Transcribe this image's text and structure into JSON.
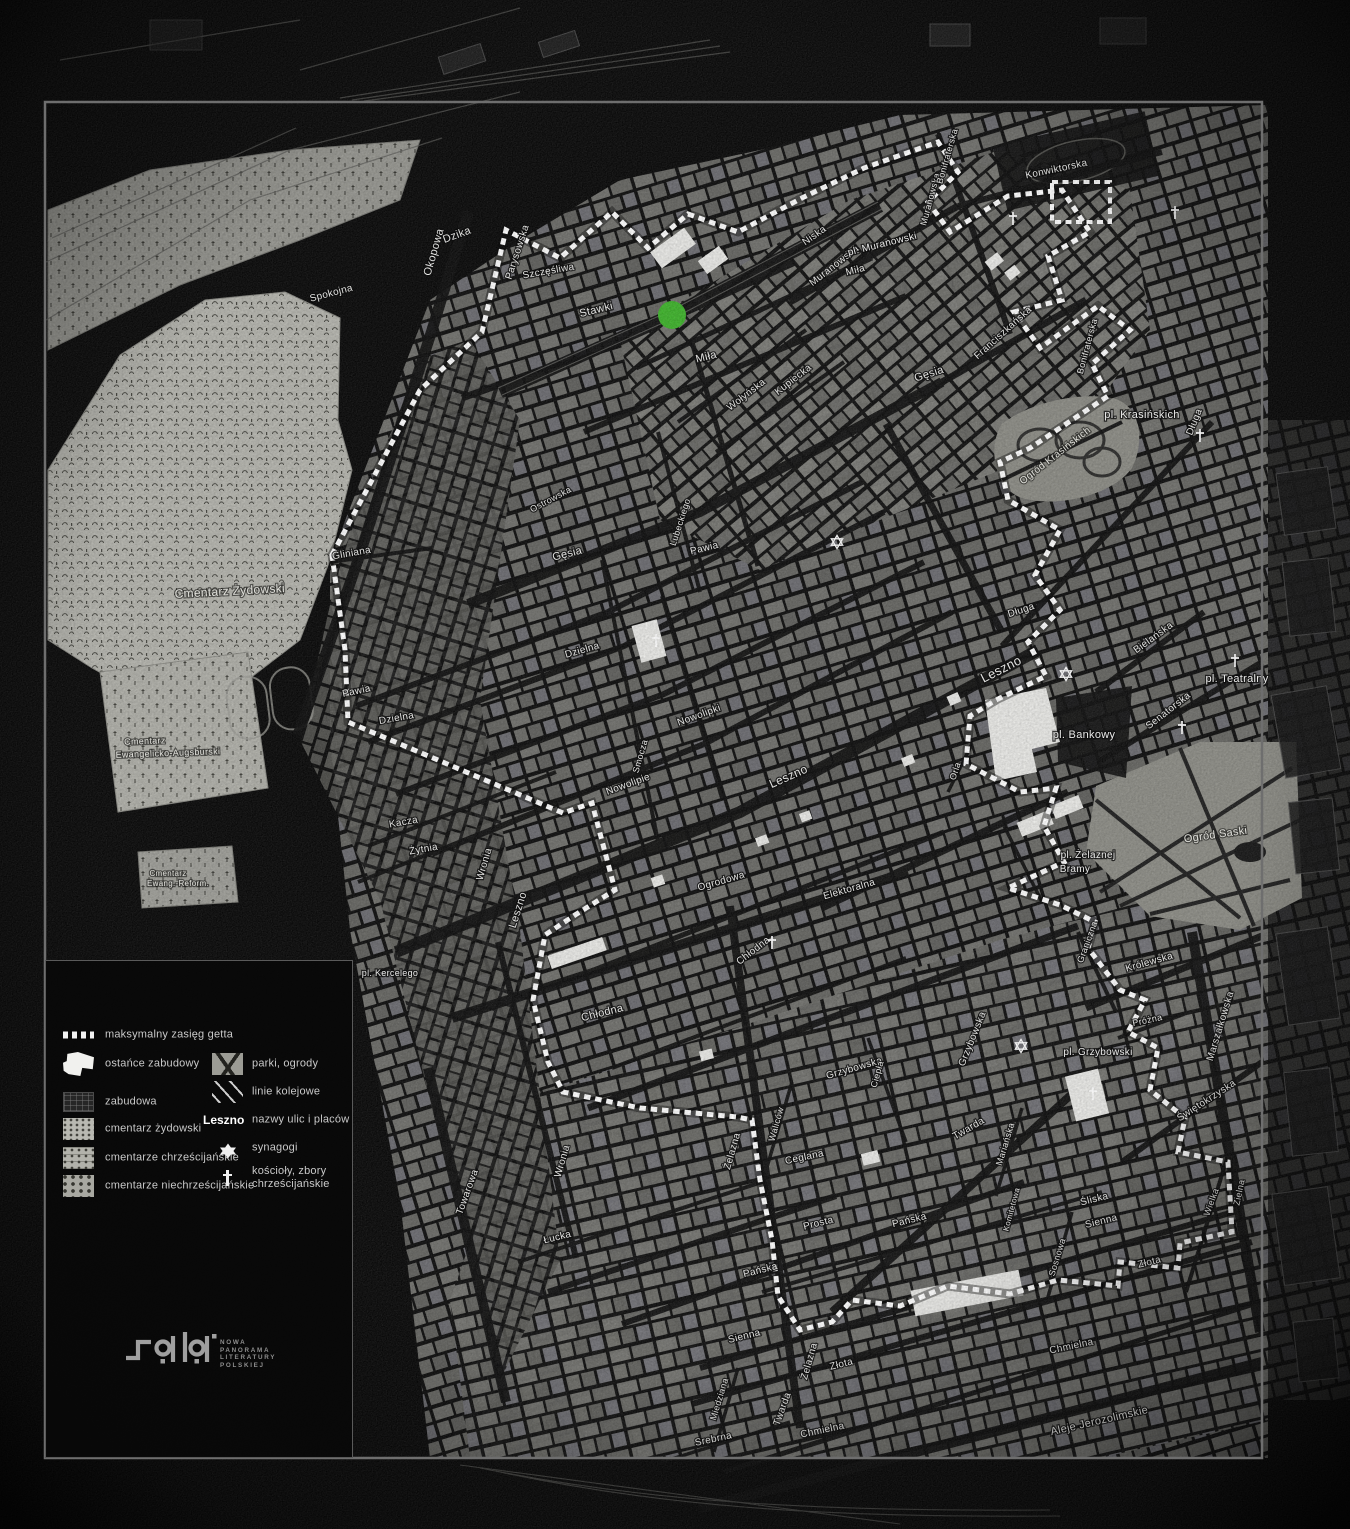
{
  "map": {
    "marker": {
      "name": "location-marker",
      "x": 672,
      "y": 315,
      "r": 14,
      "color": "#3eb42b"
    },
    "labels": [
      {
        "t": "Stawki",
        "x": 597,
        "y": 313,
        "r": -14,
        "s": 11
      },
      {
        "t": "Dzika",
        "x": 458,
        "y": 238,
        "r": -20,
        "s": 11
      },
      {
        "t": "Okopowa",
        "x": 437,
        "y": 253,
        "r": -74,
        "s": 11
      },
      {
        "t": "Parysowska",
        "x": 520,
        "y": 253,
        "r": -72,
        "s": 10
      },
      {
        "t": "Szczęśliwa",
        "x": 549,
        "y": 274,
        "r": -10,
        "s": 10
      },
      {
        "t": "Spokojna",
        "x": 332,
        "y": 296,
        "r": -15,
        "s": 10
      },
      {
        "t": "Niska",
        "x": 816,
        "y": 238,
        "r": -35,
        "s": 10
      },
      {
        "t": "Muranowska",
        "x": 836,
        "y": 268,
        "r": -38,
        "s": 10
      },
      {
        "t": "Muranowska",
        "x": 933,
        "y": 200,
        "r": -75,
        "s": 9
      },
      {
        "t": "pl. Muranowski",
        "x": 883,
        "y": 247,
        "r": -14,
        "s": 10,
        "k": "place"
      },
      {
        "t": "Miła",
        "x": 707,
        "y": 360,
        "r": -14,
        "s": 11
      },
      {
        "t": "Miła",
        "x": 856,
        "y": 273,
        "r": -14,
        "s": 10
      },
      {
        "t": "Kupiecka",
        "x": 795,
        "y": 382,
        "r": -38,
        "s": 10
      },
      {
        "t": "Wołyńska",
        "x": 748,
        "y": 397,
        "r": -38,
        "s": 10
      },
      {
        "t": "Lubeckiego",
        "x": 683,
        "y": 523,
        "r": -72,
        "s": 9
      },
      {
        "t": "Ostrowska",
        "x": 552,
        "y": 502,
        "r": -28,
        "s": 9
      },
      {
        "t": "Konwiktorska",
        "x": 1057,
        "y": 172,
        "r": -12,
        "s": 10
      },
      {
        "t": "Bonifraterska",
        "x": 950,
        "y": 157,
        "r": -74,
        "s": 9
      },
      {
        "t": "Bonifraterska",
        "x": 1090,
        "y": 347,
        "r": -75,
        "s": 9
      },
      {
        "t": "Franciszkańska",
        "x": 1005,
        "y": 335,
        "r": -42,
        "s": 10
      },
      {
        "t": "Gęsia",
        "x": 930,
        "y": 377,
        "r": -18,
        "s": 11
      },
      {
        "t": "Gęsia",
        "x": 568,
        "y": 557,
        "r": -14,
        "s": 11
      },
      {
        "t": "pl. Krasińskich",
        "x": 1142,
        "y": 418,
        "r": 0,
        "s": 11,
        "k": "place"
      },
      {
        "t": "Ogród Krasińskich",
        "x": 1057,
        "y": 458,
        "r": -38,
        "s": 10,
        "k": "area"
      },
      {
        "t": "Długa",
        "x": 1197,
        "y": 423,
        "r": -68,
        "s": 10
      },
      {
        "t": "Długa",
        "x": 1022,
        "y": 613,
        "r": -18,
        "s": 10
      },
      {
        "t": "Bielańska",
        "x": 1155,
        "y": 640,
        "r": -36,
        "s": 10
      },
      {
        "t": "pl. Teatralny",
        "x": 1237,
        "y": 682,
        "r": 0,
        "s": 11,
        "k": "place"
      },
      {
        "t": "Senatorska",
        "x": 1170,
        "y": 713,
        "r": -38,
        "s": 10
      },
      {
        "t": "pl. Bankowy",
        "x": 1084,
        "y": 738,
        "r": 0,
        "s": 11,
        "k": "place"
      },
      {
        "t": "Leszno",
        "x": 1003,
        "y": 673,
        "r": -27,
        "s": 13
      },
      {
        "t": "Leszno",
        "x": 790,
        "y": 780,
        "r": -24,
        "s": 12
      },
      {
        "t": "Leszno",
        "x": 521,
        "y": 911,
        "r": -72,
        "s": 11
      },
      {
        "t": "Ogród Saski",
        "x": 1216,
        "y": 838,
        "r": -8,
        "s": 11,
        "k": "area"
      },
      {
        "t": "pl. Żelaznej",
        "x": 1088,
        "y": 858,
        "r": 0,
        "s": 10,
        "k": "place"
      },
      {
        "t": "Bramy",
        "x": 1075,
        "y": 872,
        "r": 0,
        "s": 10,
        "k": "place"
      },
      {
        "t": "Ogrodowa",
        "x": 722,
        "y": 884,
        "r": -16,
        "s": 10
      },
      {
        "t": "Elektoralna",
        "x": 850,
        "y": 892,
        "r": -16,
        "s": 10
      },
      {
        "t": "Orla",
        "x": 958,
        "y": 772,
        "r": -72,
        "s": 9
      },
      {
        "t": "Nowolipie",
        "x": 629,
        "y": 787,
        "r": -20,
        "s": 10
      },
      {
        "t": "Nowolipki",
        "x": 700,
        "y": 718,
        "r": -20,
        "s": 10
      },
      {
        "t": "Smocza",
        "x": 643,
        "y": 757,
        "r": -74,
        "s": 9
      },
      {
        "t": "Dzielna",
        "x": 397,
        "y": 721,
        "r": -10,
        "s": 10
      },
      {
        "t": "Dzielna",
        "x": 583,
        "y": 653,
        "r": -16,
        "s": 10
      },
      {
        "t": "Pawia",
        "x": 357,
        "y": 694,
        "r": -12,
        "s": 10
      },
      {
        "t": "Pawia",
        "x": 705,
        "y": 551,
        "r": -14,
        "s": 10
      },
      {
        "t": "Gliniana",
        "x": 352,
        "y": 556,
        "r": -10,
        "s": 10
      },
      {
        "t": "Kacza",
        "x": 404,
        "y": 825,
        "r": -10,
        "s": 10
      },
      {
        "t": "Żytnia",
        "x": 424,
        "y": 852,
        "r": -10,
        "s": 10
      },
      {
        "t": "Wronia",
        "x": 487,
        "y": 865,
        "r": -74,
        "s": 10
      },
      {
        "t": "Wronia",
        "x": 565,
        "y": 1162,
        "r": -74,
        "s": 10
      },
      {
        "t": "Towarowa",
        "x": 470,
        "y": 1193,
        "r": -70,
        "s": 10
      },
      {
        "t": "pl. Kercelego",
        "x": 390,
        "y": 976,
        "r": 0,
        "s": 9,
        "k": "place"
      },
      {
        "t": "Chłodna",
        "x": 603,
        "y": 1016,
        "r": -14,
        "s": 11
      },
      {
        "t": "Chłodna",
        "x": 755,
        "y": 953,
        "r": -38,
        "s": 10
      },
      {
        "t": "Grzybowska",
        "x": 855,
        "y": 1071,
        "r": -16,
        "s": 10
      },
      {
        "t": "Grzybowska",
        "x": 975,
        "y": 1040,
        "r": -68,
        "s": 10
      },
      {
        "t": "Ciepła",
        "x": 880,
        "y": 1075,
        "r": -74,
        "s": 9
      },
      {
        "t": "pl. Grzybowski",
        "x": 1098,
        "y": 1055,
        "r": 0,
        "s": 10,
        "k": "place"
      },
      {
        "t": "Graniczna",
        "x": 1090,
        "y": 943,
        "r": -70,
        "s": 9
      },
      {
        "t": "Królewska",
        "x": 1150,
        "y": 965,
        "r": -16,
        "s": 10
      },
      {
        "t": "Próżna",
        "x": 1148,
        "y": 1023,
        "r": -12,
        "s": 9
      },
      {
        "t": "Marszałkowska",
        "x": 1223,
        "y": 1027,
        "r": -73,
        "s": 10
      },
      {
        "t": "Świętokrzyska",
        "x": 1208,
        "y": 1103,
        "r": -33,
        "s": 10
      },
      {
        "t": "Twarda",
        "x": 970,
        "y": 1131,
        "r": -30,
        "s": 10
      },
      {
        "t": "Twarda",
        "x": 785,
        "y": 1410,
        "r": -70,
        "s": 10
      },
      {
        "t": "Mariańska",
        "x": 1008,
        "y": 1145,
        "r": -73,
        "s": 9
      },
      {
        "t": "Komitetowa",
        "x": 1014,
        "y": 1210,
        "r": -75,
        "s": 8
      },
      {
        "t": "Śliska",
        "x": 1095,
        "y": 1202,
        "r": -14,
        "s": 10
      },
      {
        "t": "Sienna",
        "x": 1102,
        "y": 1224,
        "r": -14,
        "s": 10
      },
      {
        "t": "Sienna",
        "x": 745,
        "y": 1339,
        "r": -14,
        "s": 10
      },
      {
        "t": "Prosta",
        "x": 819,
        "y": 1226,
        "r": -14,
        "s": 10
      },
      {
        "t": "Łucka",
        "x": 558,
        "y": 1240,
        "r": -14,
        "s": 10
      },
      {
        "t": "Pańska",
        "x": 910,
        "y": 1223,
        "r": -14,
        "s": 10
      },
      {
        "t": "Pańska",
        "x": 761,
        "y": 1273,
        "r": -14,
        "s": 10
      },
      {
        "t": "Ceglana",
        "x": 805,
        "y": 1160,
        "r": -12,
        "s": 10
      },
      {
        "t": "Żelazna",
        "x": 735,
        "y": 1152,
        "r": -74,
        "s": 10
      },
      {
        "t": "Żelazna",
        "x": 812,
        "y": 1362,
        "r": -74,
        "s": 10
      },
      {
        "t": "Waliców",
        "x": 779,
        "y": 1125,
        "r": -74,
        "s": 9
      },
      {
        "t": "Złota",
        "x": 842,
        "y": 1367,
        "r": -14,
        "s": 10
      },
      {
        "t": "Złota",
        "x": 1150,
        "y": 1265,
        "r": -14,
        "s": 10
      },
      {
        "t": "Sosnowa",
        "x": 1060,
        "y": 1258,
        "r": -73,
        "s": 9
      },
      {
        "t": "Wielka",
        "x": 1214,
        "y": 1203,
        "r": -70,
        "s": 9
      },
      {
        "t": "Zielna",
        "x": 1242,
        "y": 1193,
        "r": -78,
        "s": 9
      },
      {
        "t": "Chmielna",
        "x": 823,
        "y": 1433,
        "r": -12,
        "s": 10
      },
      {
        "t": "Chmielna",
        "x": 1072,
        "y": 1349,
        "r": -12,
        "s": 10
      },
      {
        "t": "Srebrna",
        "x": 714,
        "y": 1442,
        "r": -12,
        "s": 10
      },
      {
        "t": "Miedziana",
        "x": 722,
        "y": 1400,
        "r": -73,
        "s": 9
      },
      {
        "t": "Aleje Jerozolimskie",
        "x": 1100,
        "y": 1424,
        "r": -13,
        "s": 11
      },
      {
        "t": "Cmentarz Żydowski",
        "x": 230,
        "y": 595,
        "r": -3,
        "s": 12,
        "k": "area"
      },
      {
        "t": "Cmentarz",
        "x": 145,
        "y": 744,
        "r": -2,
        "s": 9,
        "k": "area"
      },
      {
        "t": "Ewangelicko-Augsburski",
        "x": 168,
        "y": 756,
        "r": -2,
        "s": 9,
        "k": "area"
      },
      {
        "t": "Cmentarz",
        "x": 168,
        "y": 876,
        "r": 0,
        "s": 8,
        "k": "area"
      },
      {
        "t": "Ewang.-Reform.",
        "x": 178,
        "y": 886,
        "r": 0,
        "s": 8,
        "k": "area"
      }
    ],
    "synagogues": [
      {
        "x": 837,
        "y": 542
      },
      {
        "x": 1066,
        "y": 674
      },
      {
        "x": 1021,
        "y": 1046
      }
    ],
    "churches": [
      {
        "x": 656,
        "y": 640
      },
      {
        "x": 772,
        "y": 942
      },
      {
        "x": 1013,
        "y": 218
      },
      {
        "x": 1175,
        "y": 212
      },
      {
        "x": 1200,
        "y": 435
      },
      {
        "x": 1235,
        "y": 660
      },
      {
        "x": 1182,
        "y": 727
      },
      {
        "x": 1093,
        "y": 1093
      }
    ]
  },
  "legend": {
    "left": [
      {
        "id": "ghetto-extent",
        "label": "maksymalny zasięg getta",
        "swatch": "dashed-line"
      },
      {
        "id": "ostance-zabudowy",
        "label": "ostańce zabudowy",
        "swatch": "white-shape"
      },
      {
        "id": "zabudowa",
        "label": "zabudowa",
        "swatch": "dark-blocks"
      },
      {
        "id": "cmentarz-zydowski",
        "label": "cmentarz żydowski",
        "swatch": "light-texture"
      },
      {
        "id": "cmentarze-chrzescijanskie",
        "label": "cmentarze chrześcijańskie",
        "swatch": "light-texture-2"
      },
      {
        "id": "cmentarze-niechrzescijanskie",
        "label": "cmentarze niechrześcijańskie",
        "swatch": "light-texture-3"
      }
    ],
    "right": [
      {
        "id": "parki-ogrody",
        "label": "parki, ogrody",
        "swatch": "park-texture"
      },
      {
        "id": "linie-kolejowe",
        "label": "linie kolejowe",
        "swatch": "rail-lines"
      },
      {
        "id": "nazwy-ulic",
        "label": "nazwy ulic i placów",
        "swatch": "text",
        "swatch_text": "Leszno"
      },
      {
        "id": "synagogi",
        "label": "synagogi",
        "swatch": "star"
      },
      {
        "id": "koscioly",
        "label": "kościoły, zbory\nchrześcijańskie",
        "swatch": "cross"
      }
    ]
  },
  "logo": {
    "lines": [
      "NOWA",
      "PANORAMA",
      "LITERATURY",
      "POLSKIEJ"
    ]
  }
}
